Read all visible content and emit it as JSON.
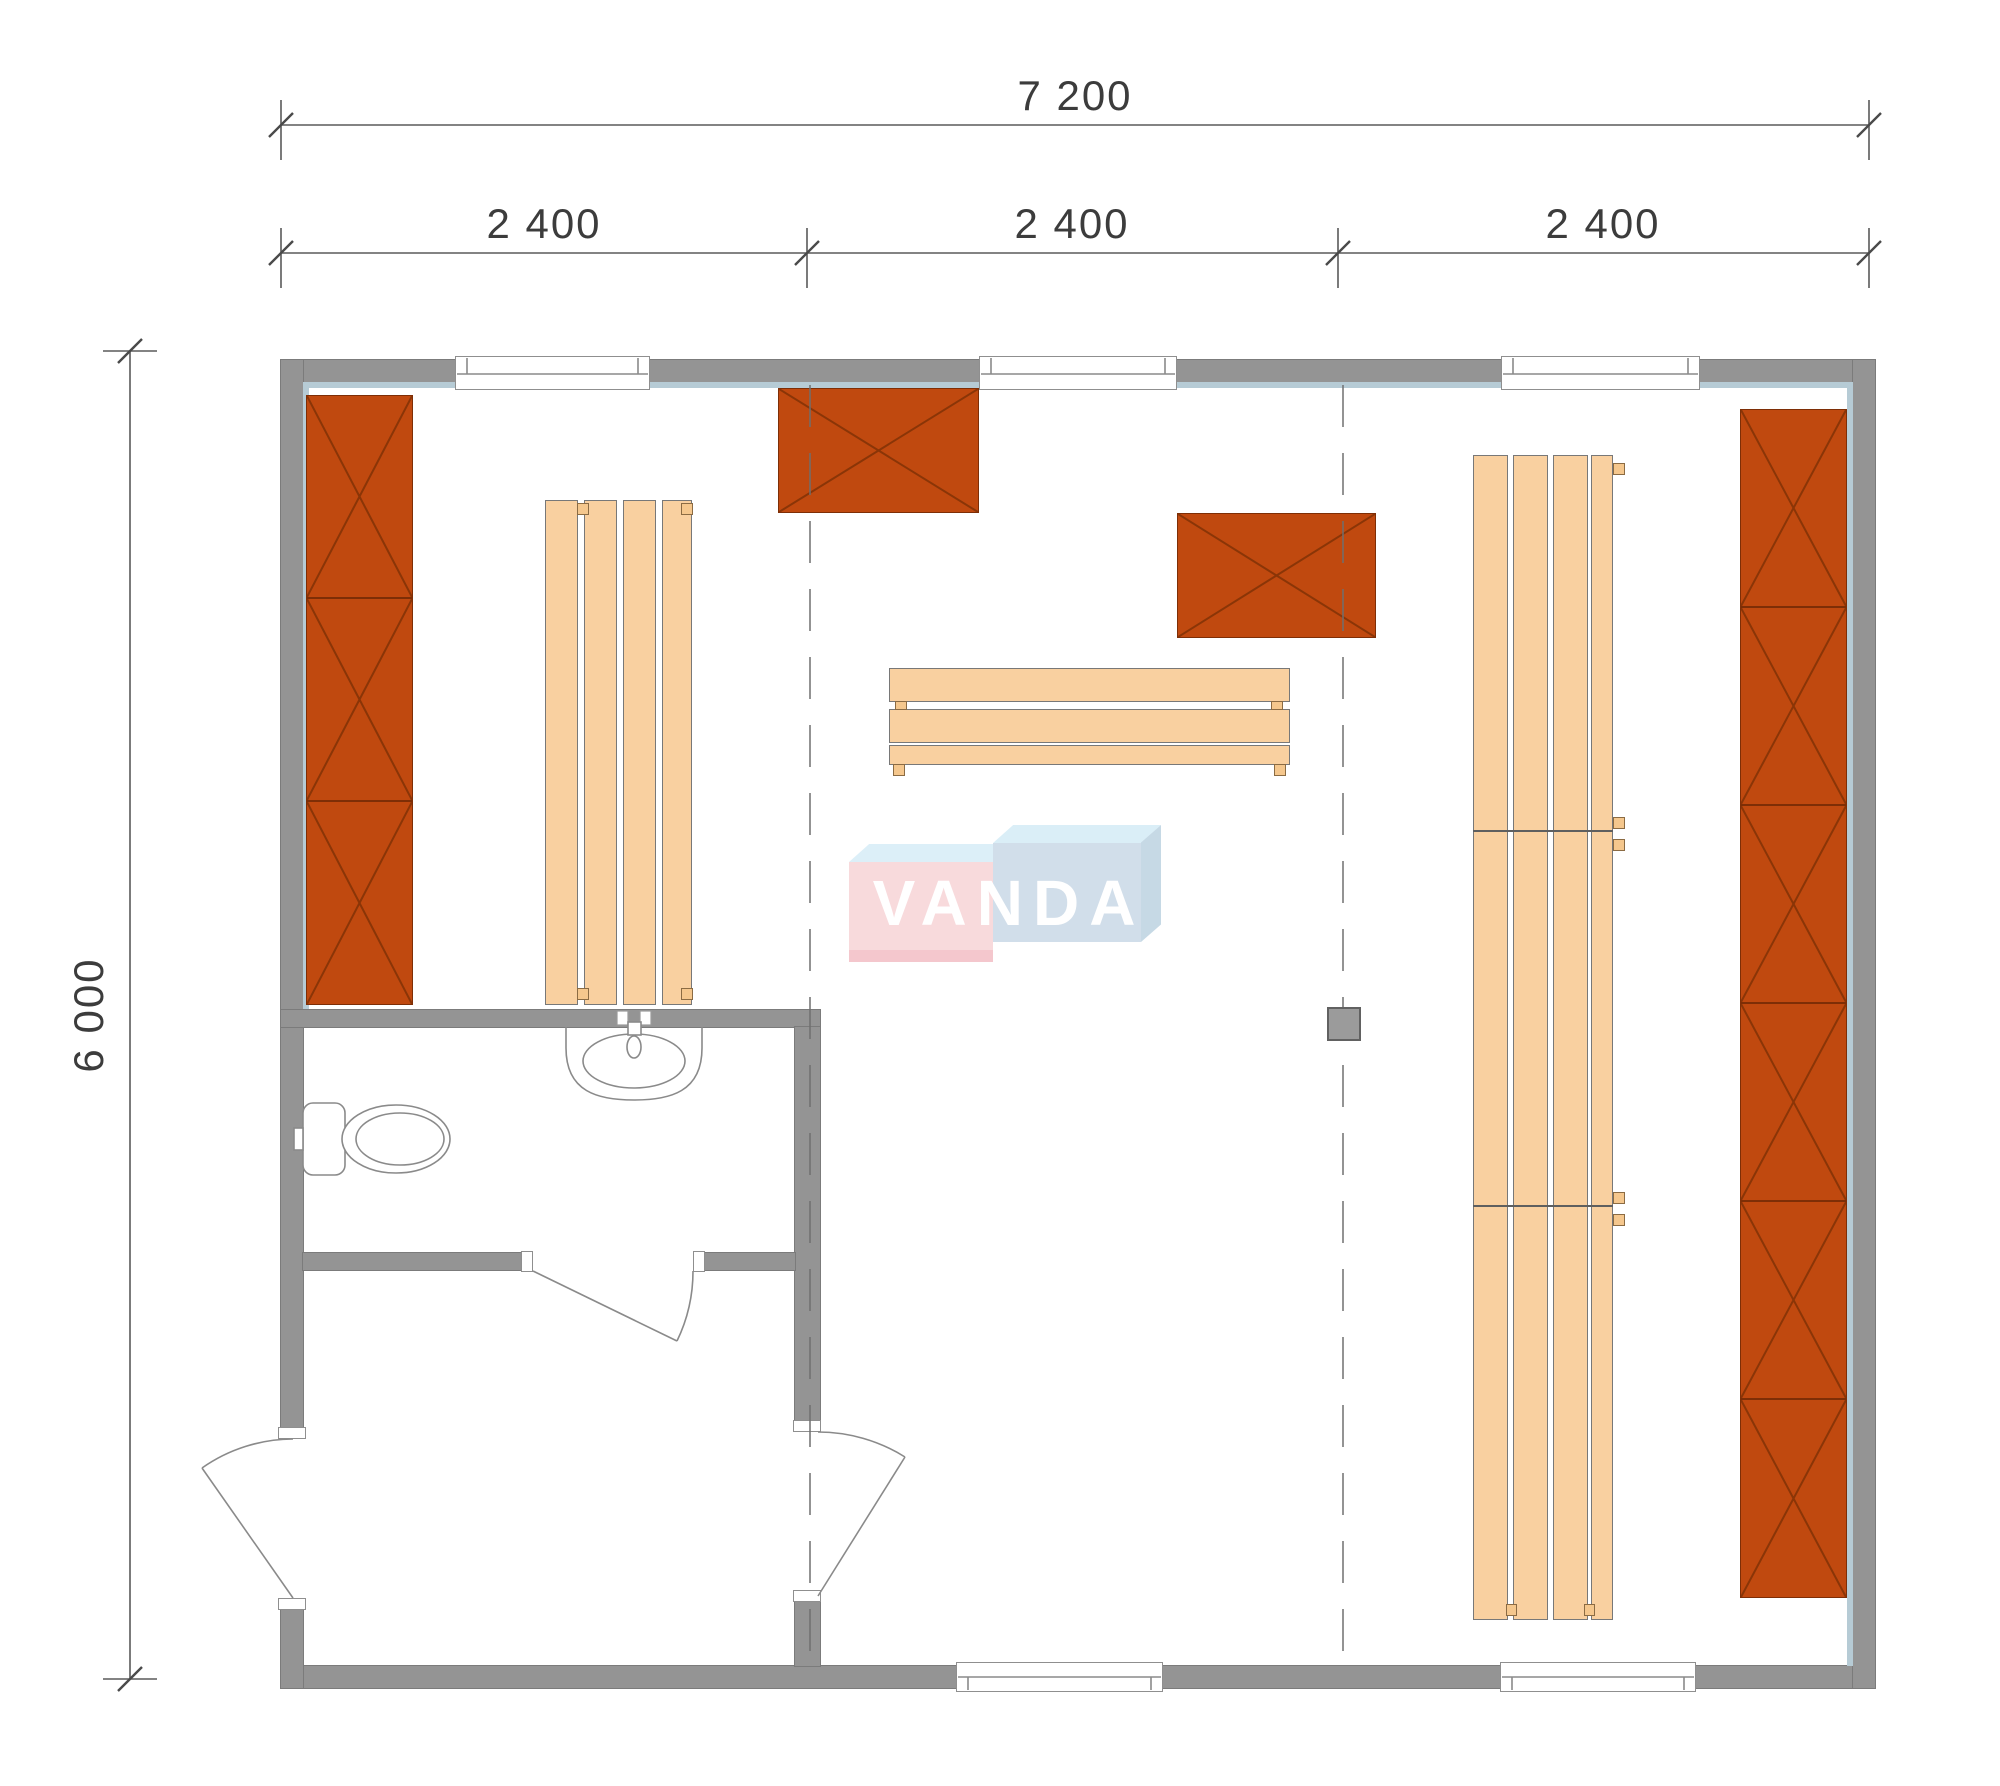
{
  "drawing": {
    "kind": "sauna-cabin-floor-plan",
    "dimensions": {
      "overall_width": "7 200",
      "modules": [
        "2 400",
        "2 400",
        "2 400"
      ],
      "overall_height": "6 000"
    },
    "watermark": {
      "text": "VANDA"
    },
    "colors": {
      "wall_gray": "#949494",
      "liner_blue": "#b6cbd5",
      "cabinet_orange": "#c0490f",
      "cabinet_hatch": "#8a3507",
      "bench_wood": "#f9d0a0",
      "stove_gray": "#9b9b9b",
      "dimension_text": "#3c3c3c",
      "watermark_red_face": "#f8d6d9",
      "watermark_blue_face": "#cddbe8",
      "watermark_cyan_top": "#d7edf7"
    }
  }
}
